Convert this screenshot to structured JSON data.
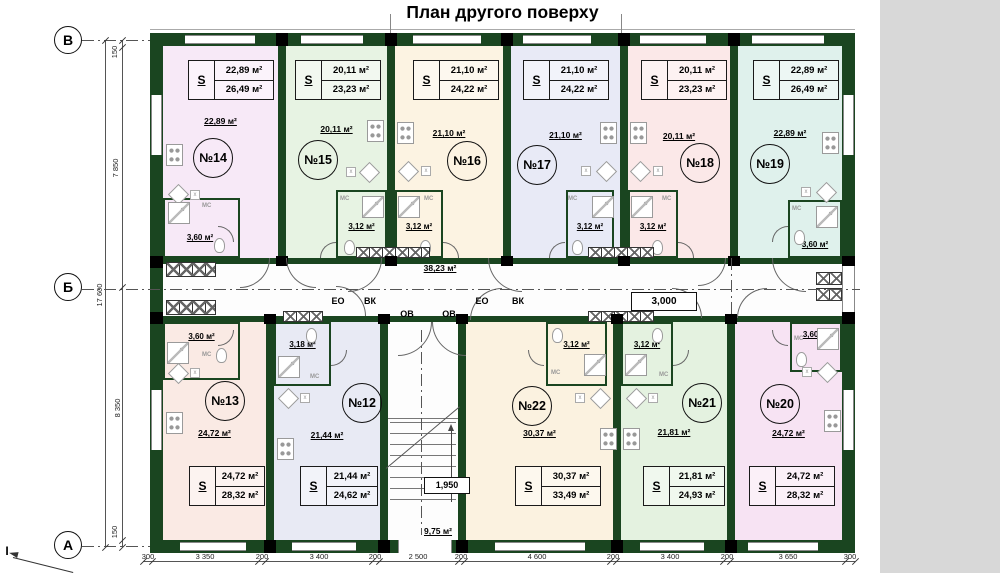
{
  "title": "План другого поверху",
  "right_panel_color": "#d8d8d8",
  "wall_color": "#1a4520",
  "floor_color": "#fdfdfd",
  "axes": {
    "rows": [
      "В",
      "Б",
      "А"
    ],
    "section_mark": "I"
  },
  "dims": {
    "left": [
      "150",
      "7 850",
      "17 600",
      "8 350",
      "150"
    ],
    "bottom": [
      "300",
      "3 350",
      "200",
      "3 400",
      "200",
      "2 500",
      "200",
      "4 600",
      "200",
      "3 400",
      "200",
      "3 650",
      "300"
    ]
  },
  "corridor": {
    "area": "38,23 м²",
    "width_dim": "3,000",
    "risers_left": [
      "ЕО",
      "ВК",
      "ОВ"
    ],
    "risers_right": [
      "ОВ",
      "ЕО",
      "ВК"
    ]
  },
  "stairwell": {
    "width_dim": "1,950",
    "area": "9,75 м²"
  },
  "labels": {
    "s": "S",
    "mc": "МС",
    "x": "х"
  },
  "apartments": [
    {
      "number": "№14",
      "living_area": "22,89 м²",
      "total_area": "26,49 м²",
      "bath_area": "3,60 м²",
      "color": "#f7e9f7"
    },
    {
      "number": "№15",
      "living_area": "20,11 м²",
      "total_area": "23,23 м²",
      "bath_area": "3,12 м²",
      "color": "#e7f3e3"
    },
    {
      "number": "№16",
      "living_area": "21,10 м²",
      "total_area": "24,22 м²",
      "bath_area": "3,12 м²",
      "color": "#fcf3e2"
    },
    {
      "number": "№17",
      "living_area": "21,10 м²",
      "total_area": "24,22 м²",
      "bath_area": "3,12 м²",
      "color": "#e8eaf6"
    },
    {
      "number": "№18",
      "living_area": "20,11 м²",
      "total_area": "23,23 м²",
      "bath_area": "3,12 м²",
      "color": "#fbe8e8"
    },
    {
      "number": "№19",
      "living_area": "22,89 м²",
      "total_area": "26,49 м²",
      "bath_area": "3,60 м²",
      "color": "#dff1ec"
    },
    {
      "number": "№13",
      "living_area": "24,72 м²",
      "total_area": "28,32 м²",
      "bath_area": "3,60 м²",
      "color": "#faeae4"
    },
    {
      "number": "№12",
      "living_area": "21,44 м²",
      "total_area": "24,62 м²",
      "bath_area": "3,18 м²",
      "color": "#e8eaf4"
    },
    {
      "number": "№22",
      "living_area": "30,37 м²",
      "total_area": "33,49 м²",
      "bath_area": "3,12 м²",
      "color": "#fbf2e0"
    },
    {
      "number": "№21",
      "living_area": "21,81 м²",
      "total_area": "24,93 м²",
      "bath_area": "3,12 м²",
      "color": "#e4f2e0"
    },
    {
      "number": "№20",
      "living_area": "24,72 м²",
      "total_area": "28,32 м²",
      "bath_area": "3,60 м²",
      "color": "#f7e3f3"
    }
  ]
}
